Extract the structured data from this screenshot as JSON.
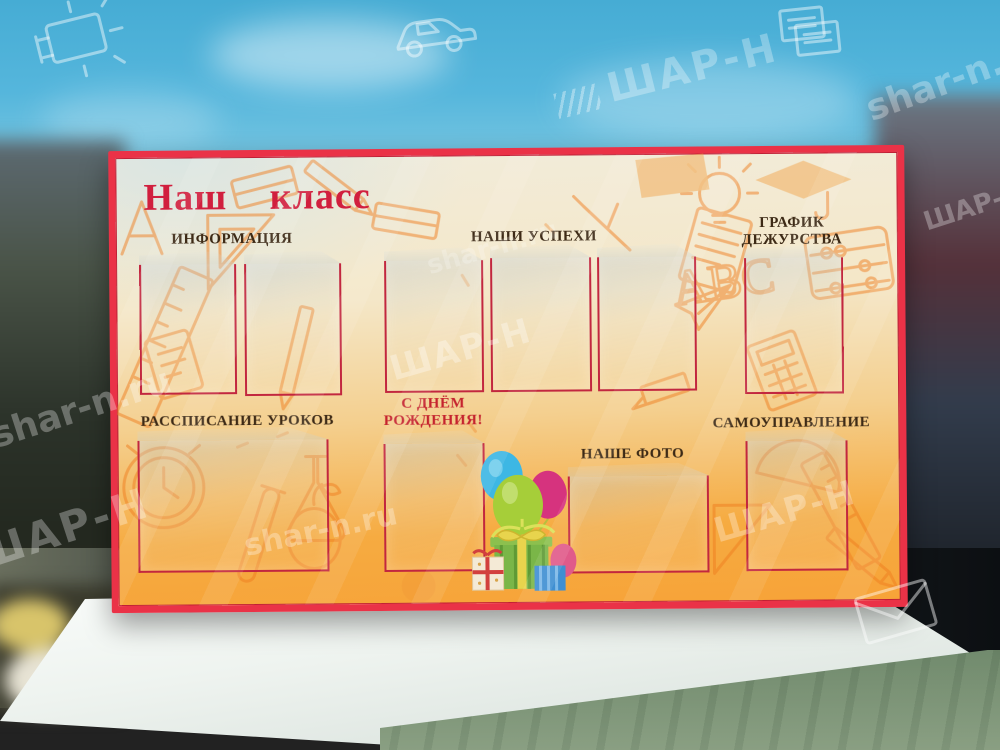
{
  "board": {
    "title": "Наш  класс",
    "sections": {
      "info": {
        "label": "ИНФОРМАЦИЯ",
        "pockets": 2
      },
      "success": {
        "label": "НАШИ  УСПЕХИ",
        "pockets": 3
      },
      "duty": {
        "label_lines": [
          "ГРАФИК",
          "ДЕЖУРСТВА"
        ],
        "pockets": 1
      },
      "schedule": {
        "label": "РАССПИСАНИЕ УРОКОВ",
        "pockets": 1
      },
      "birthday": {
        "label_lines": [
          "С ДНЁМ",
          "РОЖДЕНИЯ!"
        ],
        "pockets": 1
      },
      "our_photo": {
        "label": "НАШЕ ФОТО",
        "pockets": 1
      },
      "self_government": {
        "label": "САМОУПРАВЛЕНИЕ",
        "pockets": 1
      }
    },
    "colors": {
      "frame_red": "#ea3247",
      "panel_cream": "#f2ecda",
      "panel_orange": "#f7a338",
      "doodle_orange": "#ee7d1f",
      "title_red": "#d11f3e",
      "label_brown": "#3d2a16",
      "pocket_border": "#c2273f",
      "birthday_text_red": "#c5232e",
      "balloon_blue": "#3db7e4",
      "balloon_green": "#a6ce39",
      "balloon_magenta": "#d6337e",
      "gift_green": "#7ab648"
    }
  },
  "watermarks": {
    "site": "shar-n.ru",
    "brand": "ШАР-Н"
  },
  "icons": {
    "top_left": "video-projector-icon",
    "top_center": "car-icon",
    "top_right": "documents-icon",
    "bottom_right": "envelope-icon"
  }
}
